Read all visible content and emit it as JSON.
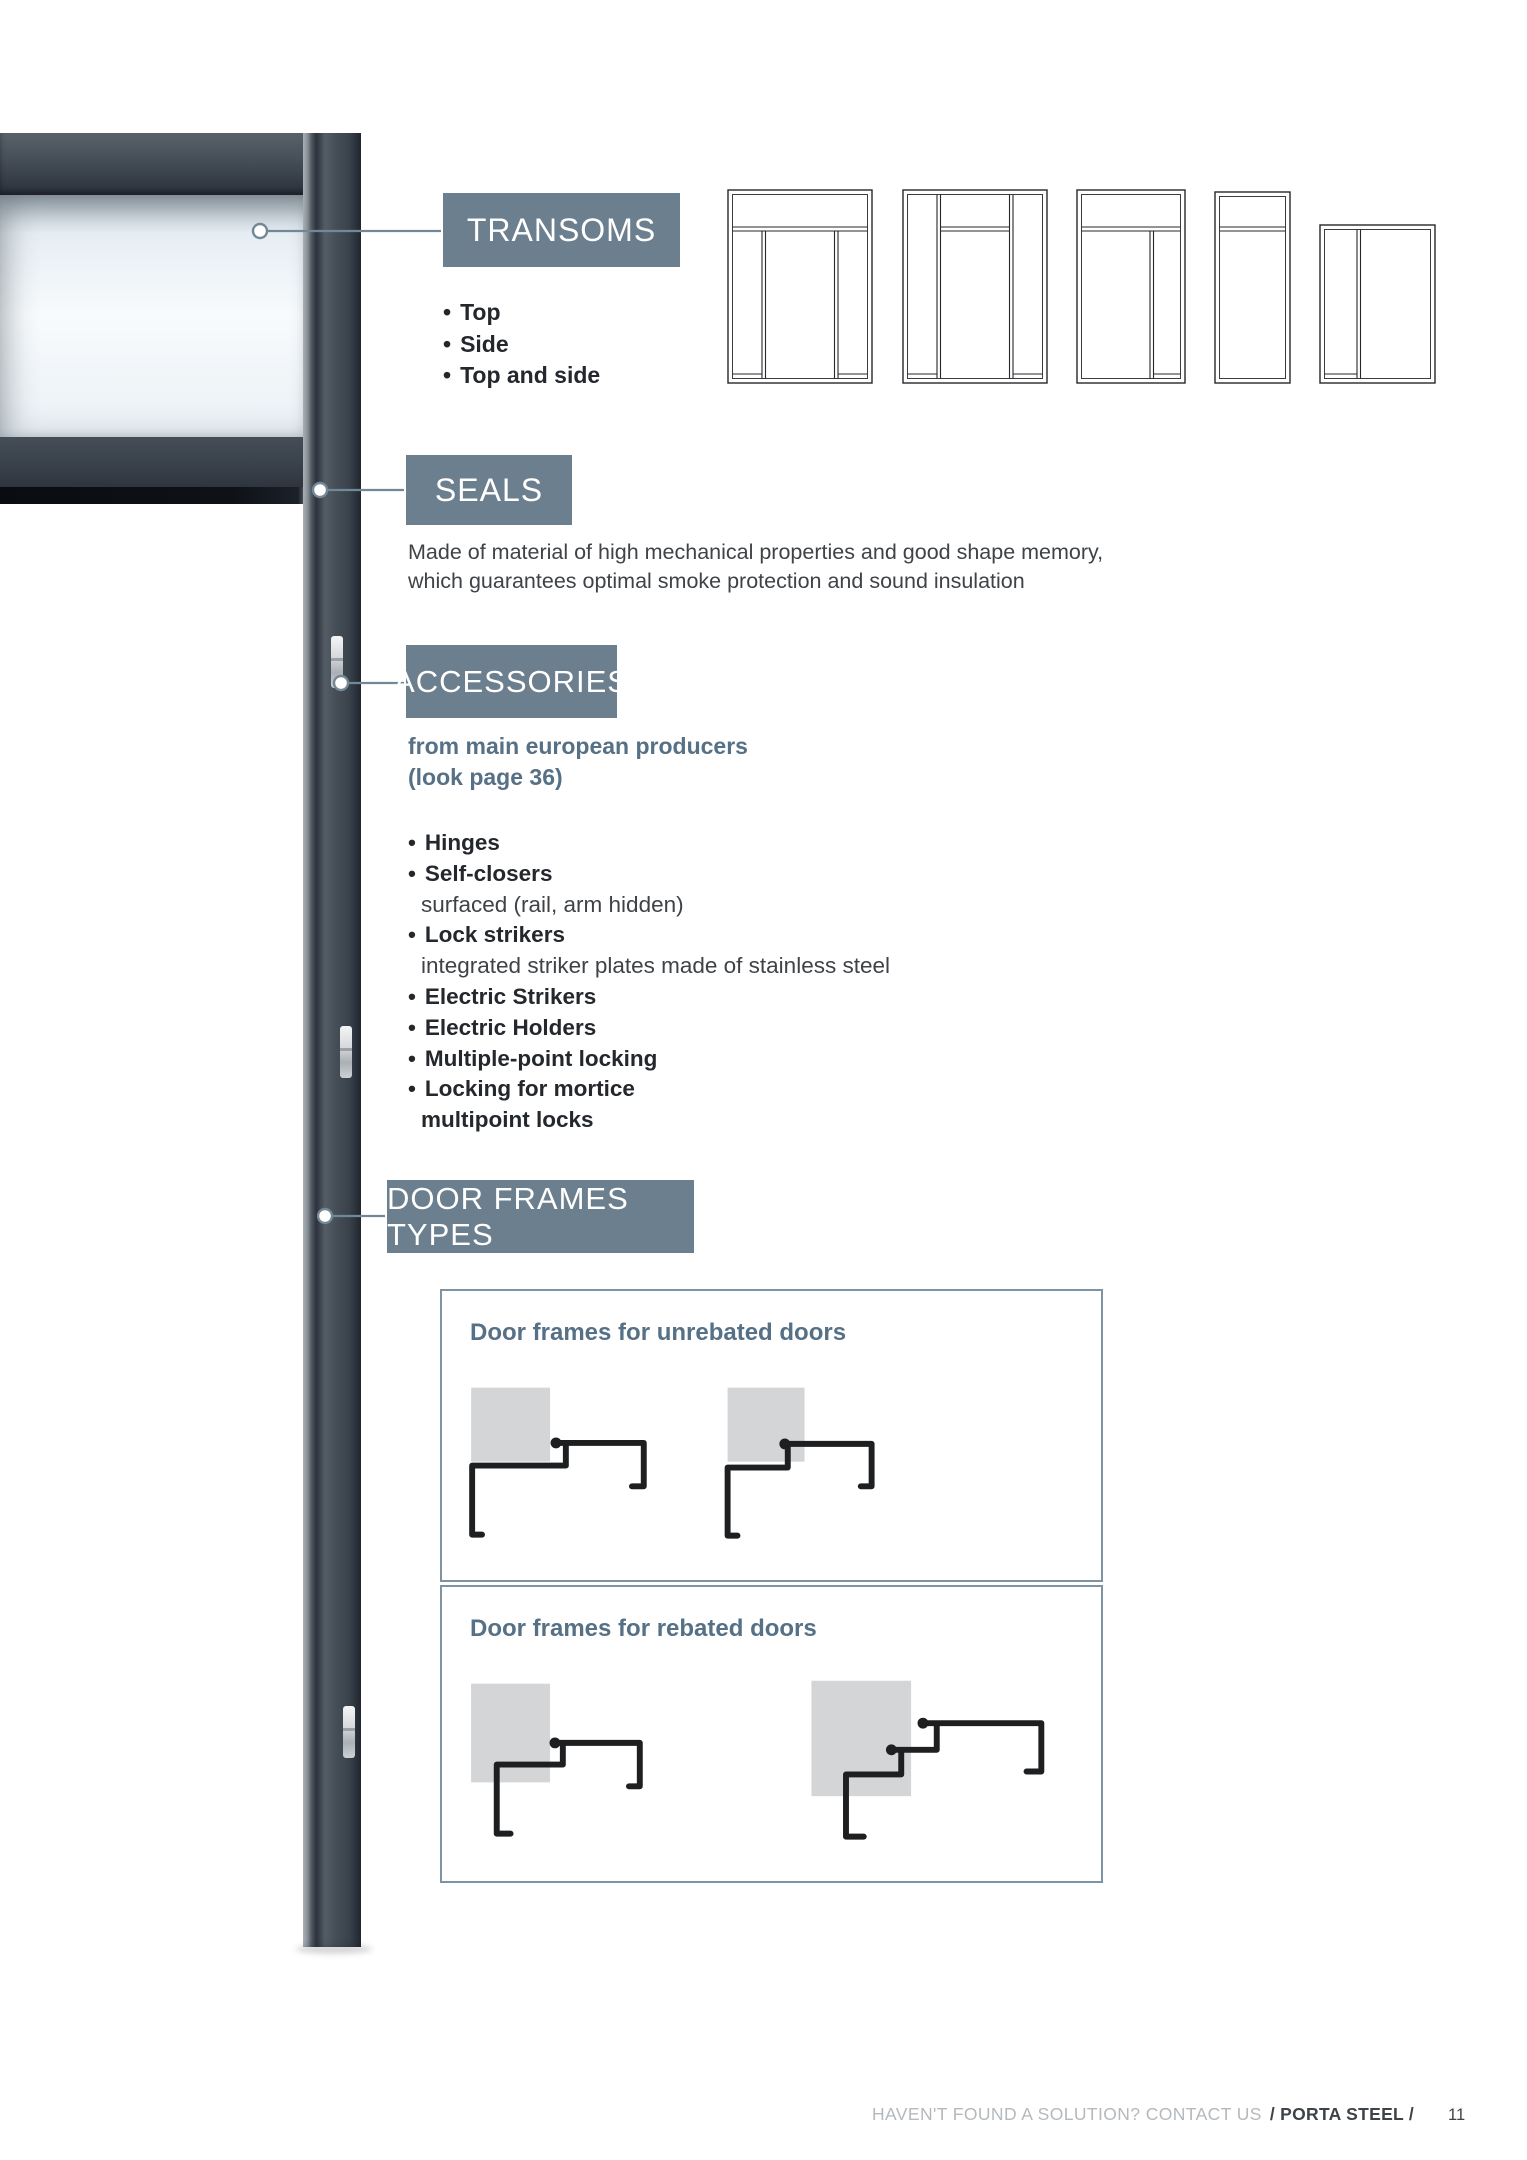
{
  "glyphs": {
    "bullet": "•"
  },
  "colors": {
    "accent_slate": "#6c7f8e",
    "title_slate": "#567086",
    "line_slate": "#738897",
    "frame_dark": "#39414b",
    "profile_black": "#1d1f21",
    "wall_gray": "#d3d5d6"
  },
  "sections": {
    "transoms": {
      "title": "TRANSOMS",
      "bullets": [
        {
          "label": "Top"
        },
        {
          "label": "Side"
        },
        {
          "label": "Top and side"
        }
      ]
    },
    "seals": {
      "title": "SEALS",
      "desc_line1": "Made of material of high mechanical properties and good shape memory,",
      "desc_line2": "which guarantees optimal smoke protection and sound insulation"
    },
    "accessories": {
      "title": "ACCESSORIES",
      "source_line1": "from main european producers",
      "source_line2": "(look page 36)",
      "items": [
        {
          "label": "Hinges"
        },
        {
          "label": "Self-closers"
        },
        {
          "label": "surfaced (rail, arm hidden)"
        },
        {
          "label": "Lock strikers"
        },
        {
          "label": "integrated striker plates made of stainless steel"
        },
        {
          "label": "Electric Strikers"
        },
        {
          "label": "Electric Holders"
        },
        {
          "label": "Multiple-point locking"
        },
        {
          "label": "Locking for mortice"
        },
        {
          "label": "multipoint locks"
        }
      ]
    },
    "door_frames": {
      "title": "DOOR FRAMES TYPES",
      "box1_title": "Door frames for unrebated doors",
      "box2_title": "Door frames for rebated doors"
    }
  },
  "footer": {
    "muted": "HAVEN'T FOUND A SOLUTION? CONTACT US",
    "brand": "/ PORTA STEEL /",
    "page_number": "11"
  }
}
